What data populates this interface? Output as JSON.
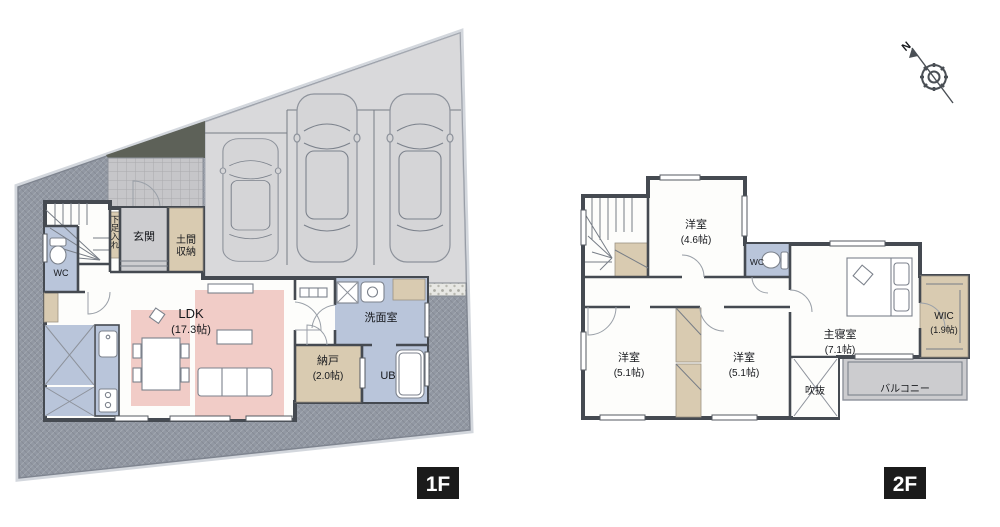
{
  "floor1": {
    "tag": "1F",
    "rooms": {
      "wc": "WC",
      "genkan": "玄関",
      "shoe_storage": "下足入れ",
      "doma_line1": "土間",
      "doma_line2": "収納",
      "ldk": "LDK",
      "ldk_area": "(17.3帖)",
      "nando": "納戸",
      "nando_area": "(2.0帖)",
      "senmen": "洗面室",
      "ub": "UB"
    }
  },
  "floor2": {
    "tag": "2F",
    "rooms": {
      "yoshitsu46": "洋室",
      "yoshitsu46_area": "(4.6帖)",
      "wc": "WC",
      "shusin": "主寝室",
      "shusin_area": "(7.1帖)",
      "wic": "WIC",
      "wic_area": "(1.9帖)",
      "yoshitsu51l": "洋室",
      "yoshitsu51l_area": "(5.1帖)",
      "yoshitsu51r": "洋室",
      "yoshitsu51r_area": "(5.1帖)",
      "fukinuke": "吹抜",
      "balcony": "バルコニー"
    }
  },
  "compass": {
    "north": "N"
  },
  "colors": {
    "wall": "#454a51",
    "yard": "#9298a3",
    "driveway": "#d9d9db",
    "room_blue": "#b9c5da",
    "room_pink": "#f1ccc7",
    "room_tan": "#d9cbb1",
    "porch": "#c6c6c9",
    "gravel": "#e7e7e3",
    "balcony": "#cccccf",
    "label_bg": "#1b1b1b"
  }
}
